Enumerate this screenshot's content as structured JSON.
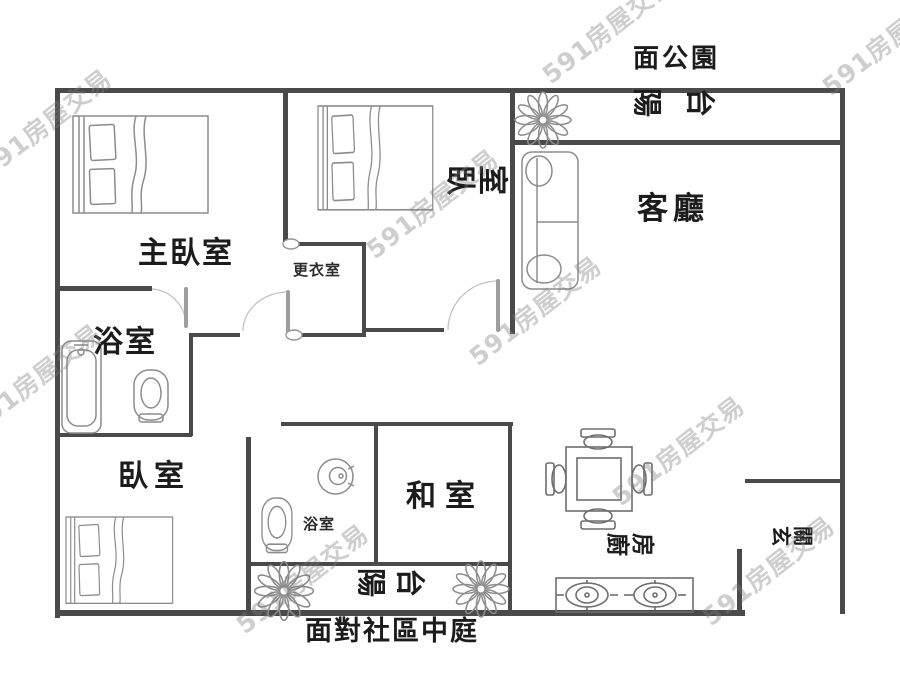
{
  "watermark_text": "591房屋交易",
  "colors": {
    "wall": "#4a4a4a",
    "label": "#1c1c1c",
    "furniture_line": "#8c8c8c",
    "watermark": "#7d7d7d"
  },
  "labels": {
    "facing_park": "面公園",
    "balcony_top": "陽台",
    "living_room": "客廳",
    "master_bedroom": "主臥室",
    "bedroom_top": "臥室",
    "dressing_room": "更衣室",
    "bathroom_main": "浴室",
    "bedroom_bottom": "臥室",
    "tatami_room": "和室",
    "bathroom_small": "浴室",
    "balcony_bottom": "陽台",
    "kitchen": "廚房",
    "entryway": "玄關",
    "facing_courtyard": "面對社區中庭"
  }
}
